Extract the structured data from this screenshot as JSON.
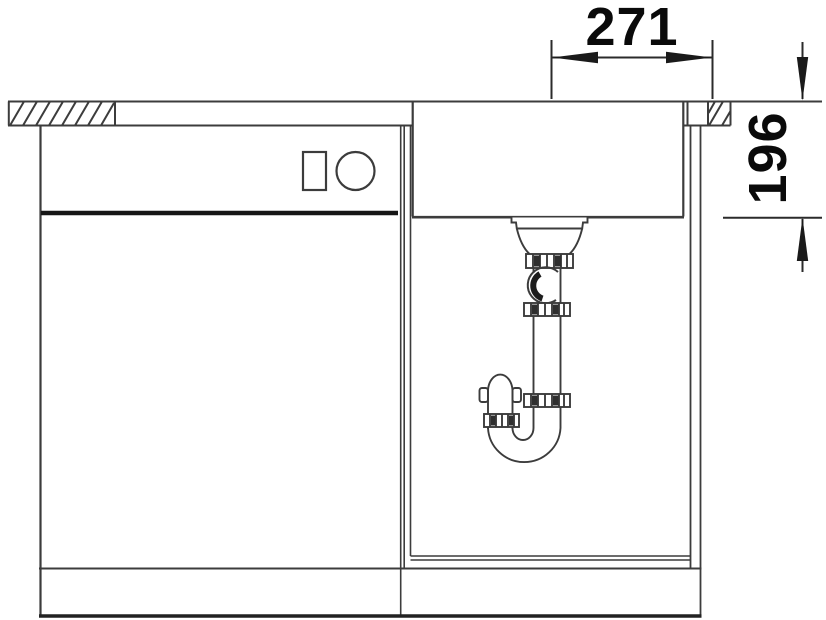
{
  "drawing": {
    "kind": "technical-installation-drawing",
    "view": "sink-base-cabinet-front-view",
    "background_color": "#ffffff",
    "line_color": "#3c3c3c",
    "heavy_line_color": "#161616",
    "text_color": "#0a0a0a",
    "dimensions": {
      "horizontal": {
        "label": "271"
      },
      "vertical": {
        "label": "196"
      }
    },
    "parts": [
      "worktop",
      "worktop-cross-section-left",
      "worktop-cross-section-right",
      "sink-bowl",
      "drain-strainer",
      "tailpiece",
      "slip-nut",
      "swivel-elbow",
      "p-trap",
      "left-base-unit",
      "drawer-front",
      "drawer-handle-symbols",
      "partition-wall",
      "sink-base-compartment",
      "right-side-panel",
      "plinth"
    ]
  }
}
